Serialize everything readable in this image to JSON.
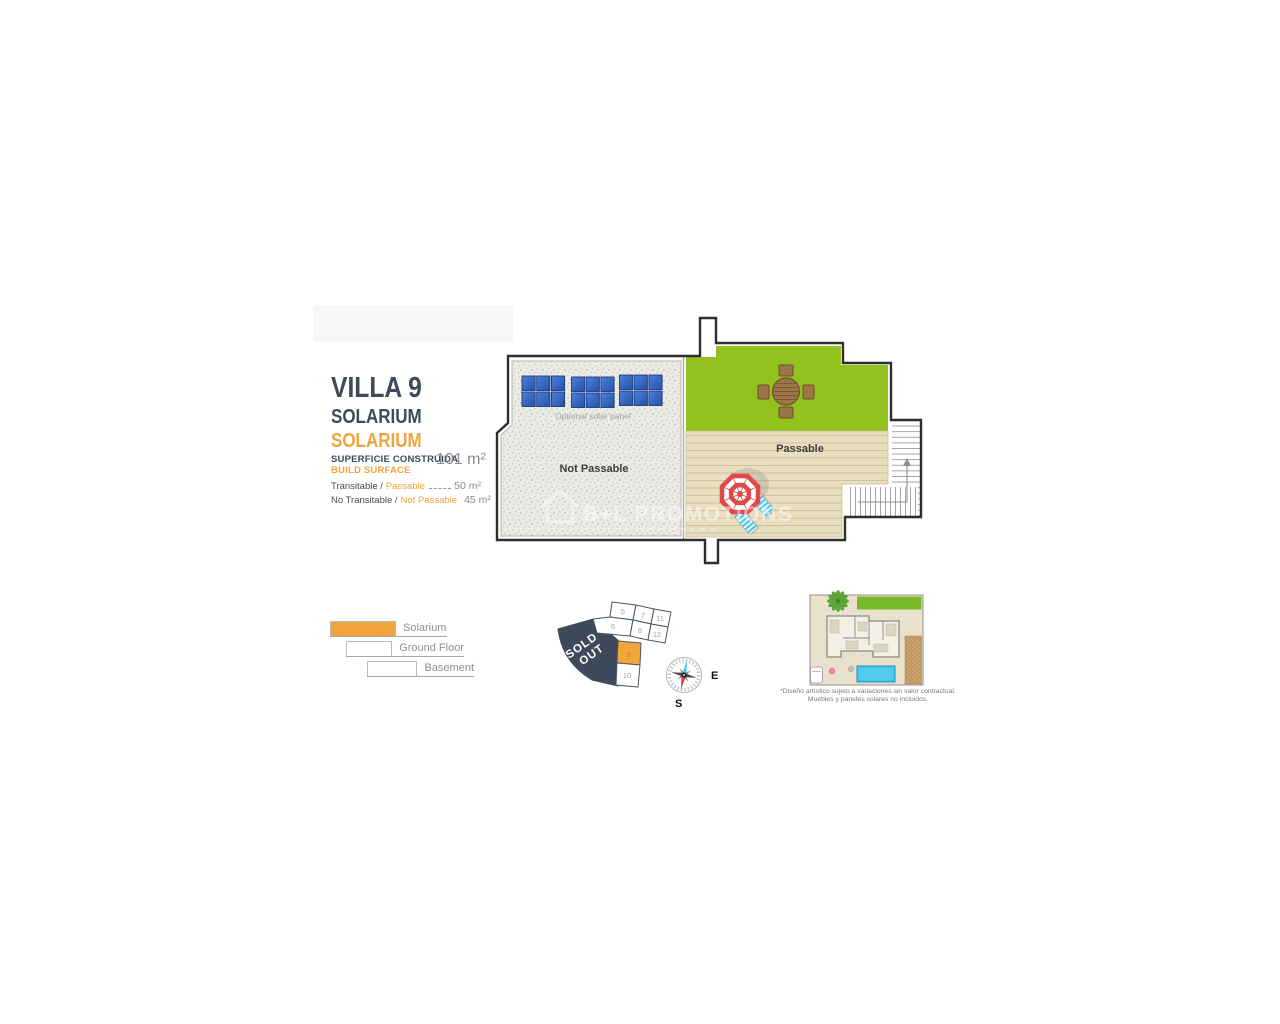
{
  "info": {
    "title": "VILLA 9",
    "subtitle_es": "SOLARIUM",
    "subtitle_en": "SOLARIUM",
    "surface": {
      "label_es": "SUPERFICIE CONSTRUIDA",
      "label_en": "BUILD SURFACE",
      "value": "101 m²"
    },
    "areas": [
      {
        "label_es": "Transitable /",
        "label_en": "Passable",
        "value": "50 m²"
      },
      {
        "label_es": "No Transitable /",
        "label_en": "Not Passable",
        "value": "45 m²"
      }
    ]
  },
  "plan": {
    "not_passable_label": "Not Passable",
    "passable_label": "Passable",
    "solar_label": "Optional solar panel",
    "watermark_text": "B+L PROMOTIONS"
  },
  "legend": {
    "items": [
      {
        "label": "Solarium",
        "fill": "#F2A43C"
      },
      {
        "label": "Ground Floor",
        "fill": "#FFFFFF"
      },
      {
        "label": "Basement",
        "fill": "#FFFFFF"
      }
    ]
  },
  "plot_map": {
    "sold_out": {
      "line1": "SOLD",
      "line2": "OUT"
    },
    "highlight_color": "#F2A53A",
    "plots": [
      {
        "number": "5"
      },
      {
        "number": "7"
      },
      {
        "number": "11"
      },
      {
        "number": "6"
      },
      {
        "number": "8"
      },
      {
        "number": "12"
      },
      {
        "number": "9",
        "highlighted": true
      },
      {
        "number": "10"
      }
    ]
  },
  "compass": {
    "east_label": "E",
    "south_label": "S"
  },
  "site_thumbnail": {
    "caption_line1": "*Diseño artístico sujeto a variaciones sin valor contractual.",
    "caption_line2": "Muebles y paneles solares no incluidos."
  },
  "colors": {
    "navy": "#3E4A5A",
    "orange": "#F2A43C",
    "grass_green": "#93C21F",
    "deck_wood": "#EADEC0",
    "gravel": "#EDEBE6",
    "wall": "#2E2E2E",
    "solar_blue": "#2F5FC2",
    "umbrella_red": "#E04A4A",
    "lounger_cyan": "#55C8E6",
    "sold_out_bg": "#3E4A5C",
    "pool_blue": "#41C3EA"
  }
}
